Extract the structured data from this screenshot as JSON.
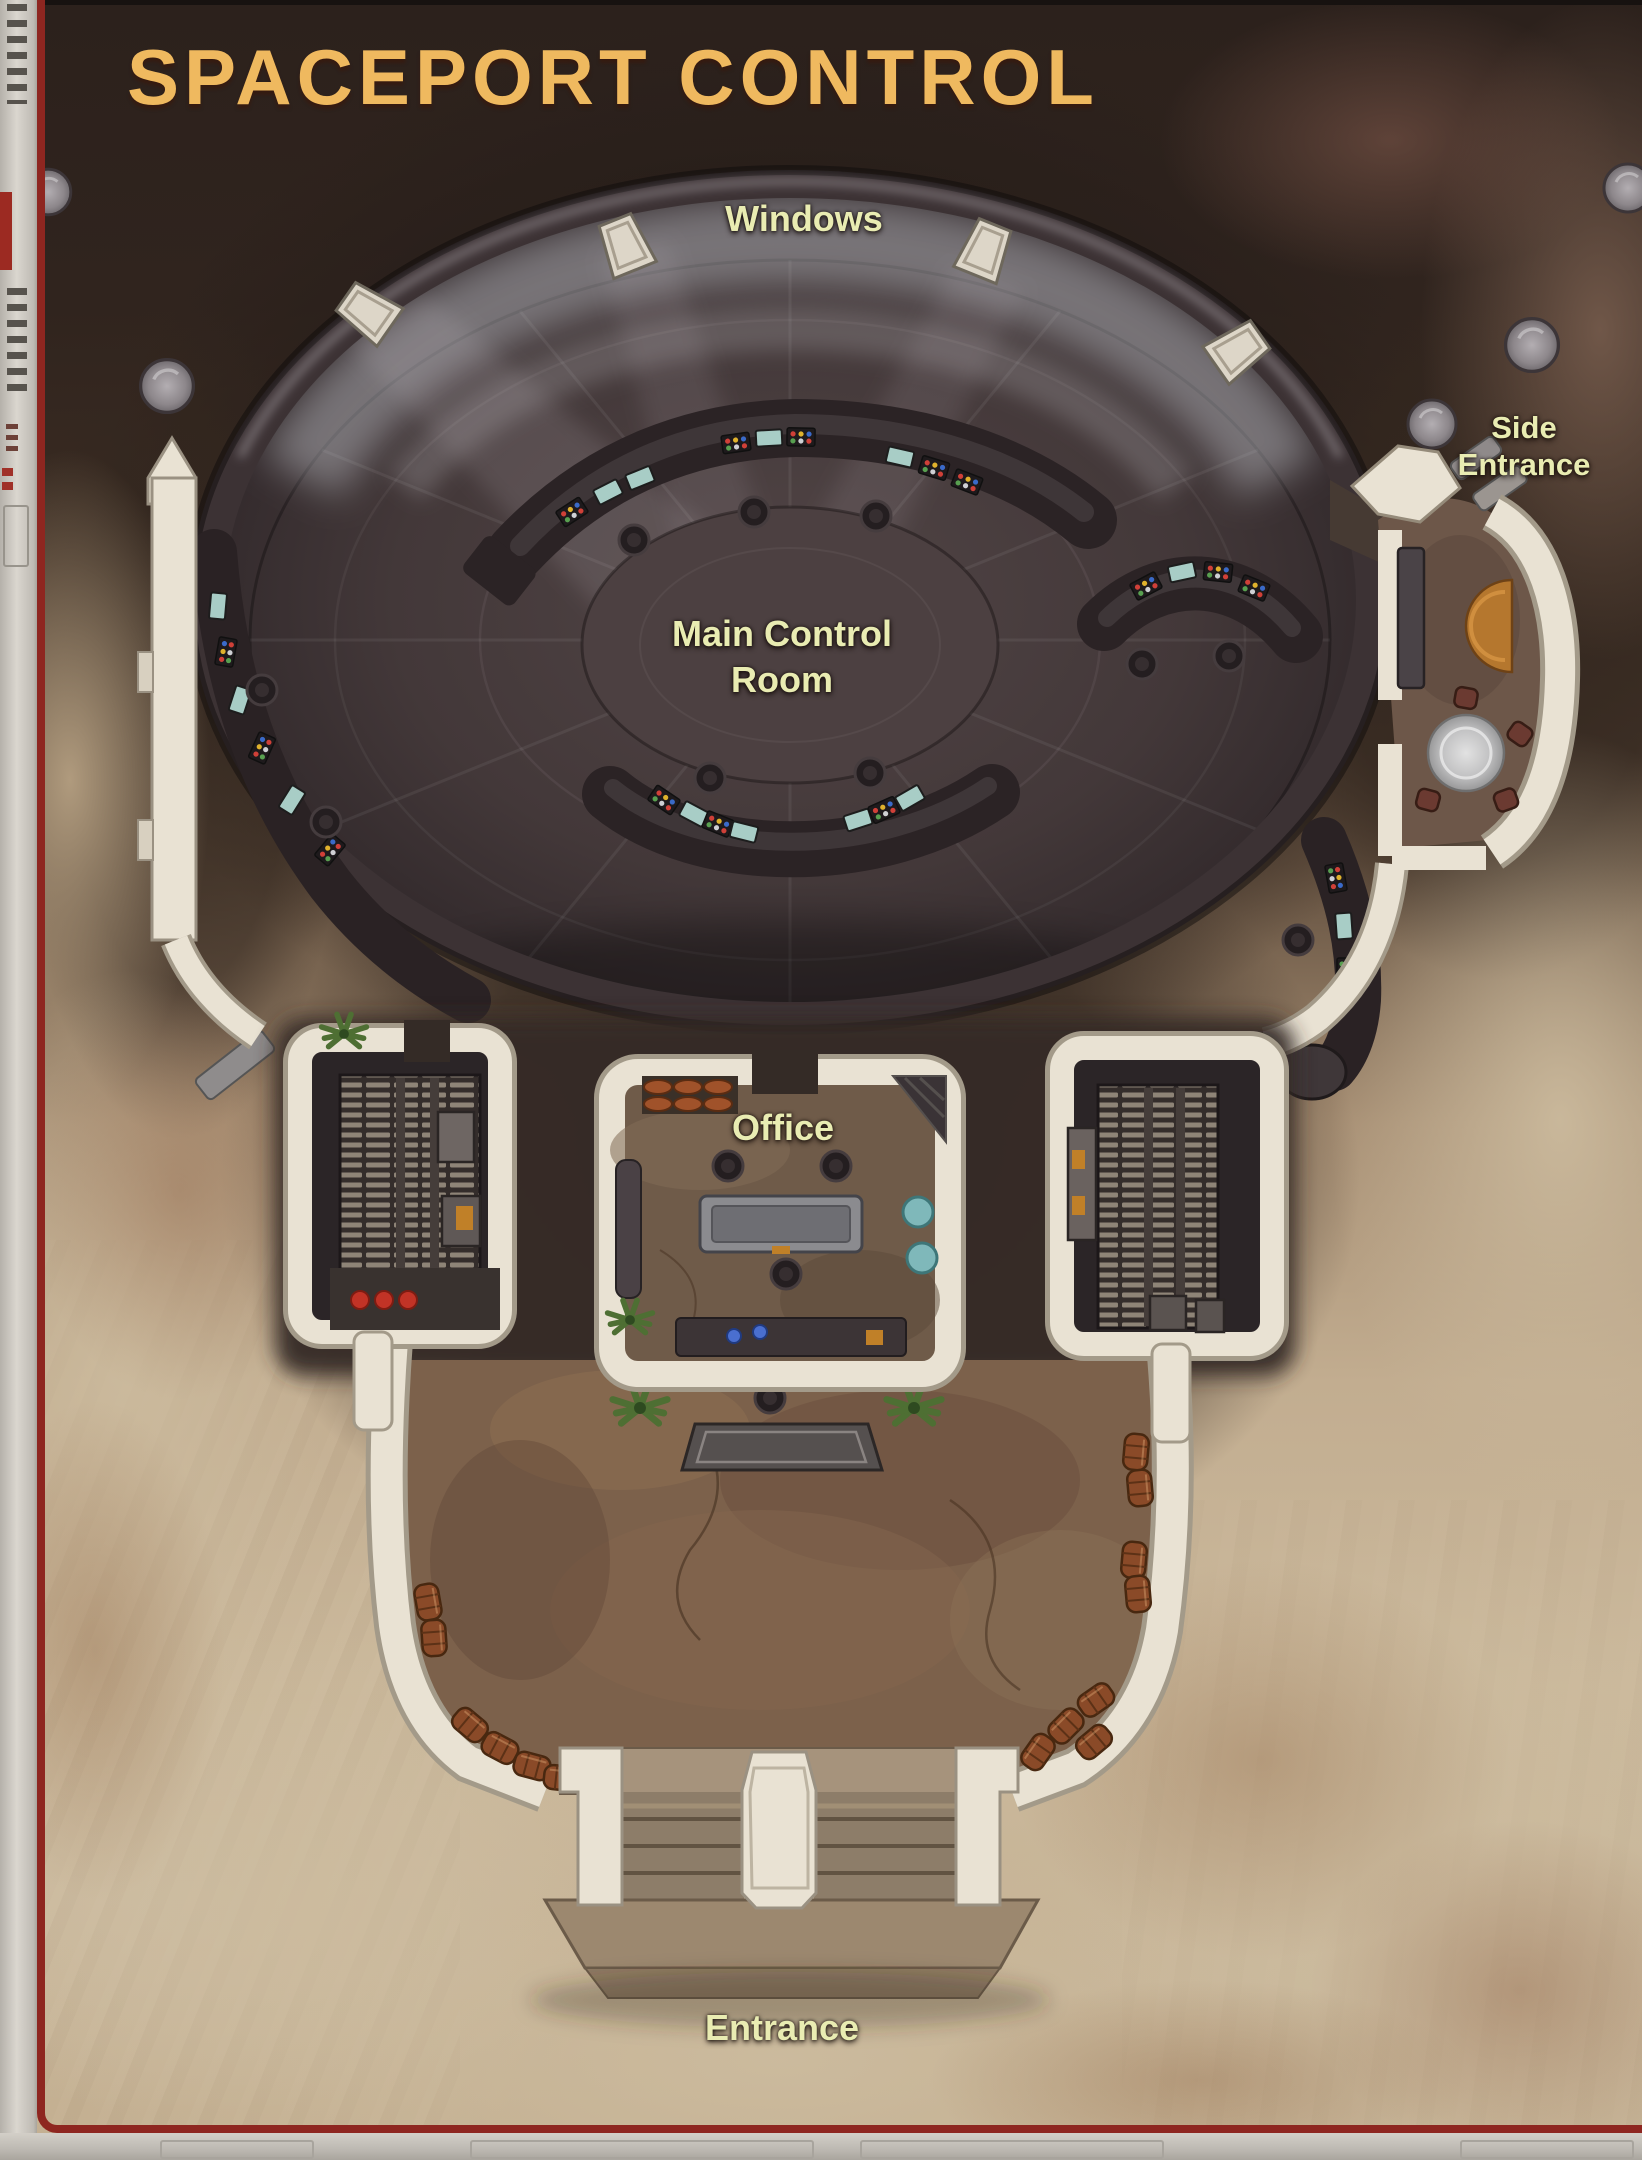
{
  "title": "SPACEPORT CONTROL",
  "labels": {
    "windows": "Windows",
    "main_control_room": {
      "line1": "Main Control",
      "line2": "Room"
    },
    "office": "Office",
    "entrance": "Entrance",
    "side_entrance": {
      "line1": "Side",
      "line2": "Entrance"
    }
  },
  "rooms": [
    "Main Control Room",
    "Office",
    "Side Entrance",
    "Entrance Hall",
    "Machinery Room West",
    "Machinery Room East"
  ],
  "features": [
    "curved-control-consoles",
    "operator-chairs",
    "rim-windows",
    "window-light-beams",
    "round-table-with-stools",
    "scroll-shelf",
    "office-desk",
    "machinery-floor-grates",
    "barrel-stacks",
    "entrance-steps",
    "desert-boulders",
    "plants",
    "orange-awning"
  ],
  "counts": {
    "rim_windows": 4,
    "boulders": 5,
    "table_stools": 4
  },
  "colors": {
    "title": "#efb95f",
    "label": "#e9ecb2",
    "border_red": "#8e2620",
    "wall": "#e9e2d3",
    "dome_floor": "#463b3c",
    "console": "#2b2325",
    "screen_teal": "#a8cdc6",
    "sand": "#c8b599",
    "hall_floor": "#7c614b",
    "awning_orange": "#b5772e",
    "barrel": "#8a4a28",
    "alert_red": "#c23326",
    "stool_teal": "#7fb8ba"
  }
}
